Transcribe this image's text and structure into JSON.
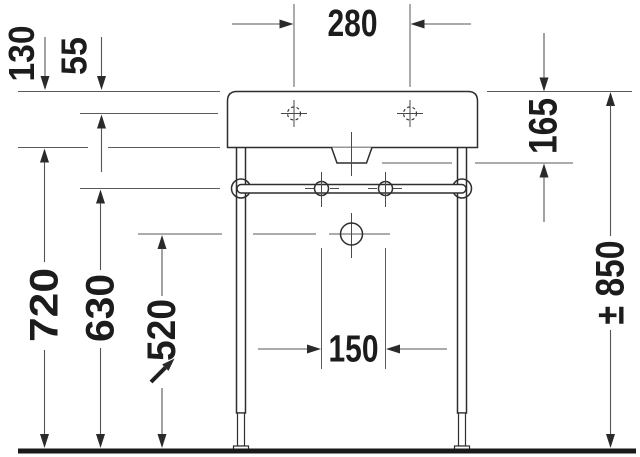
{
  "drawing": {
    "kind": "console-washbasin-front-elevation",
    "units_implied": "mm",
    "colors": {
      "background": "#ffffff",
      "object_line": "#2e2e2e",
      "dimension_line": "#555555",
      "text": "#1c1c1c",
      "floor": "#1a1a1a"
    },
    "dimensions": {
      "faucet_hole_spacing": "280",
      "basin_front_height": "130",
      "rim_to_faucet_axis": "55",
      "rim_to_siphon_cover_bottom": "165",
      "floor_to_basin_underside": "720",
      "floor_to_towel_rail_axis": "630",
      "floor_to_drain_axis": "520",
      "lower_fixing_spacing": "150",
      "overall_height_adjustable": "± 850"
    },
    "icons": {
      "adjustable_height_arrow": "northeast-arrow"
    }
  }
}
